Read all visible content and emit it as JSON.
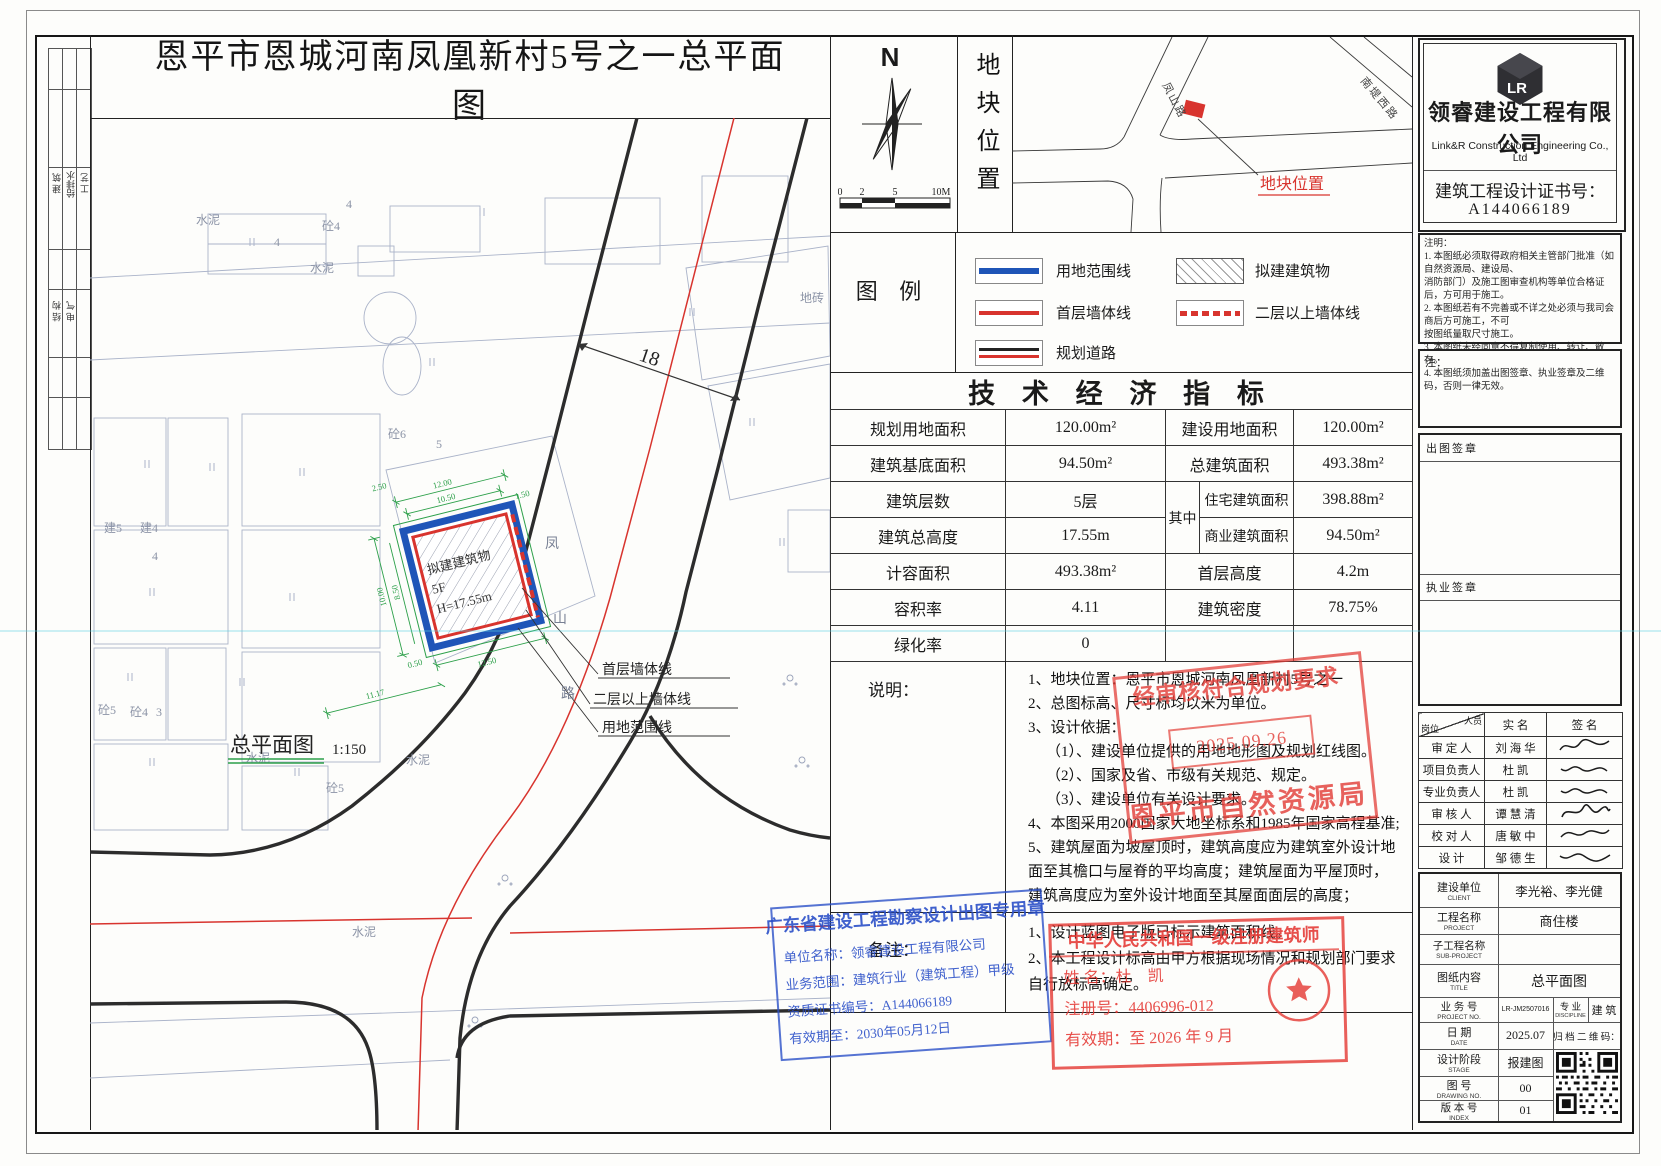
{
  "drawing": {
    "title": "恩平市恩城河南凤凰新村5号之一总平面图",
    "view_label": "总平面图",
    "view_scale": "1:150",
    "building": {
      "l1": "拟建建筑物",
      "l2": "5F",
      "l3": "H=17.55m"
    },
    "road": {
      "c1": "凤",
      "c2": "山",
      "c3": "路"
    },
    "dim18": "18",
    "dims": {
      "d1": "12.00",
      "d2": "10.50",
      "d3": "2.50",
      "d4": "1.50",
      "d5": "10.00",
      "d6": "8.50",
      "d7": "0.50",
      "d8": "12.50",
      "d9": "11.17"
    },
    "callouts": {
      "c1": "首层墙体线",
      "c2": "二层以上墙体线",
      "c3": "用地范围线"
    },
    "labels": {
      "l1": "砼4",
      "l2": "4",
      "l3": "4",
      "l4": "水泥",
      "l5": "水泥",
      "l6": "砼6",
      "l7": "5",
      "l8": "建5",
      "l9": "建4",
      "l10": "4",
      "l11": "砼5",
      "l12": "砼4",
      "l13": "3",
      "l14": "砼5",
      "l15": "水泥",
      "l16": "水泥",
      "l17": "水泥",
      "l18": "地砖"
    }
  },
  "left_strip": {
    "c1": "建 筑",
    "c2": "给排水",
    "c3": "工 艺",
    "c4": "结 构",
    "c5": "电 气"
  },
  "north": {
    "label": "N"
  },
  "scalebar": {
    "t0": "0",
    "t1": "2",
    "t2": "5",
    "t3": "10M"
  },
  "location": {
    "panel_title": "地块位置",
    "road_a": "凤山路",
    "road_b": "南堤西路",
    "marker_label": "地块位置"
  },
  "legend": {
    "title": "图  例",
    "i1": "用地范围线",
    "i2": "首层墙体线",
    "i3": "规划道路",
    "i4": "拟建建筑物",
    "i5": "二层以上墙体线"
  },
  "indicators": {
    "title": "技 术 经 济 指 标",
    "r1c1": "规划用地面积",
    "r1v1": "120.00m²",
    "r1c2": "建设用地面积",
    "r1v2": "120.00m²",
    "r2c1": "建筑基底面积",
    "r2v1": "94.50m²",
    "r2c2": "总建筑面积",
    "r2v2": "493.38m²",
    "r3c1": "建筑层数",
    "r3v1": "5层",
    "qz": "其中",
    "r3c2": "住宅建筑面积",
    "r3v2": "398.88m²",
    "r4c1": "建筑总高度",
    "r4v1": "17.55m",
    "r4c2": "商业建筑面积",
    "r4v2": "94.50m²",
    "r5c1": "计容面积",
    "r5v1": "493.38m²",
    "r5c2": "首层高度",
    "r5v2": "4.2m",
    "r6c1": "容积率",
    "r6v1": "4.11",
    "r6c2": "建筑密度",
    "r6v2": "78.75%",
    "r7c1": "绿化率",
    "r7v1": "0"
  },
  "notes": {
    "label": "说明：",
    "l1": "1、地块位置：恩平市恩城河南凤凰新村5号之一",
    "l2": "2、总图标高、尺寸标均以米为单位。",
    "l3": "3、设计依据：",
    "l4": "（1）、建设单位提供的用地地形图及规划红线图。",
    "l5": "（2）、国家及省、市级有关规范、规定。",
    "l6": "（3）、建设单位有关设计要求。",
    "l7": "4、本图采用2000国家大地坐标系和1985年国家高程基准;",
    "l8": "5、建筑屋面为坡屋顶时，建筑高度应为建筑室外设计地",
    "l9": "面至其檐口与屋脊的平均高度；建筑屋面为平屋顶时，",
    "l10": "建筑高度应为室外设计地面至其屋面面层的高度；"
  },
  "remarks": {
    "label": "备注：",
    "l1": "1、设计蓝图电子版已标示建筑面积线。",
    "l2": "2、本工程设计标高由甲方根据现场情况和规划部门要求",
    "l3": "自行放标高确定。"
  },
  "company": {
    "logo_text": "LR",
    "name_cn": "领睿建设工程有限公司",
    "name_en": "Link&R Construction Engineering Co., Ltd",
    "cert_label": "建筑工程设计证书号：",
    "cert_no": "A144066189"
  },
  "instructions": {
    "label": "注明：",
    "l1": "1. 本图纸必须取得政府相关主管部门批准（如自然资源局、建设局、",
    "l2": "消防部门）及施工图审查机构等单位合格证后，方可用于施工。",
    "l3": "2. 本图纸若有不完善或不详之处必须与我司会商后方可施工，不可",
    "l4": "按图纸量取尺寸施工。",
    "l5": "3. 本图纸未经同意不得复制使用、转让、散存。",
    "l6": "4. 本图纸须加盖出图签章、执业签章及二维码，否则一律无效。"
  },
  "seal_boxes": {
    "note_label": "注：",
    "chutu": "出图签章",
    "zhiye": "执业签章"
  },
  "sign_table": {
    "h_post": "岗位",
    "h_person": "人员",
    "h_name": "实  名",
    "h_sig": "签  名",
    "r1p": "审 定 人",
    "r1n": "刘 海 华",
    "r2p": "项目负责人",
    "r2n": "杜  凯",
    "r3p": "专业负责人",
    "r3n": "杜  凯",
    "r4p": "审 核 人",
    "r4n": "谭 慧 清",
    "r5p": "校 对 人",
    "r5n": "唐 敏 中",
    "r6p": "设  计",
    "r6n": "邹 德 生"
  },
  "titleblock": {
    "client_label": "建设单位",
    "client_sub": "CLIENT",
    "client": "李光裕、李光健",
    "project_label": "工程名称",
    "project_sub": "PROJECT",
    "project": "商住楼",
    "subproj_label": "子工程名称",
    "subproj_sub": "SUB-PROJECT",
    "subproj": "",
    "content_label": "图纸内容",
    "content_sub": "TITLE",
    "content": "总平面图",
    "no_label": "业 务 号",
    "no_sub": "PROJECT NO.",
    "no": "LR-JM2507016",
    "disc_label": "专  业",
    "disc_sub": "DISCIPLINE",
    "disc": "建  筑",
    "date_label": "日  期",
    "date_sub": "DATE",
    "date": "2025.07",
    "qr_label": "归 档 二 维 码：",
    "stage_label": "设计阶段",
    "stage_sub": "STAGE",
    "stage": "报建图",
    "dwg_label": "图  号",
    "dwg_sub": "DRAWING NO.",
    "dwg": "00",
    "index_label": "版 本 号",
    "index_sub": "INDEX",
    "index": "01"
  },
  "stamps": {
    "review": {
      "line1": "经审核符合规划要求",
      "date": "2025.09.26",
      "line2": "恩平市自然资源局"
    },
    "blue": {
      "title": "广东省建设工程勘察设计出图专用章",
      "l1": "单位名称：领睿建设工程有限公司",
      "l2": "业务范围：建筑行业（建筑工程）甲级",
      "l3": "资质证书编号：A144066189",
      "l4": "有效期至：2030年05月12日"
    },
    "architect": {
      "title": "中华人民共和国一级注册建筑师",
      "name_label": "姓  名：",
      "name": "杜  凯",
      "reg_label": "注册号：",
      "reg": "4406996-012",
      "valid_label": "有效期：",
      "valid": "至 2026 年 9 月"
    }
  }
}
